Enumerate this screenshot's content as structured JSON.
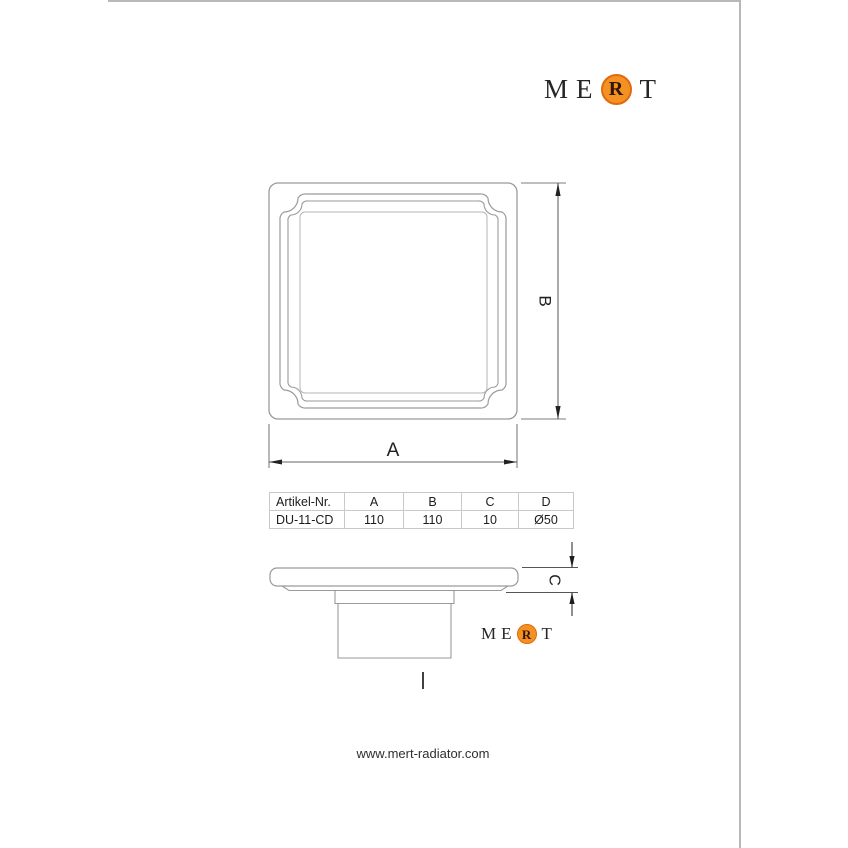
{
  "page": {
    "background": "#ffffff",
    "border_color": "#bab6bc"
  },
  "logo": {
    "m": "M",
    "e": "E",
    "r": "R",
    "t": "T",
    "circle_fill": "#f39123",
    "circle_border": "#e06a10"
  },
  "drawing": {
    "dim_a_label": "A",
    "dim_b_label": "B",
    "dim_c_label": "C",
    "line_color": "#9a9a9a",
    "dim_color": "#666666"
  },
  "table": {
    "headers": [
      "Artikel-Nr.",
      "A",
      "B",
      "C",
      "D"
    ],
    "row": [
      "DU-11-CD",
      "110",
      "110",
      "10",
      "Ø50"
    ]
  },
  "footer": {
    "website": "www.mert-radiator.com"
  }
}
